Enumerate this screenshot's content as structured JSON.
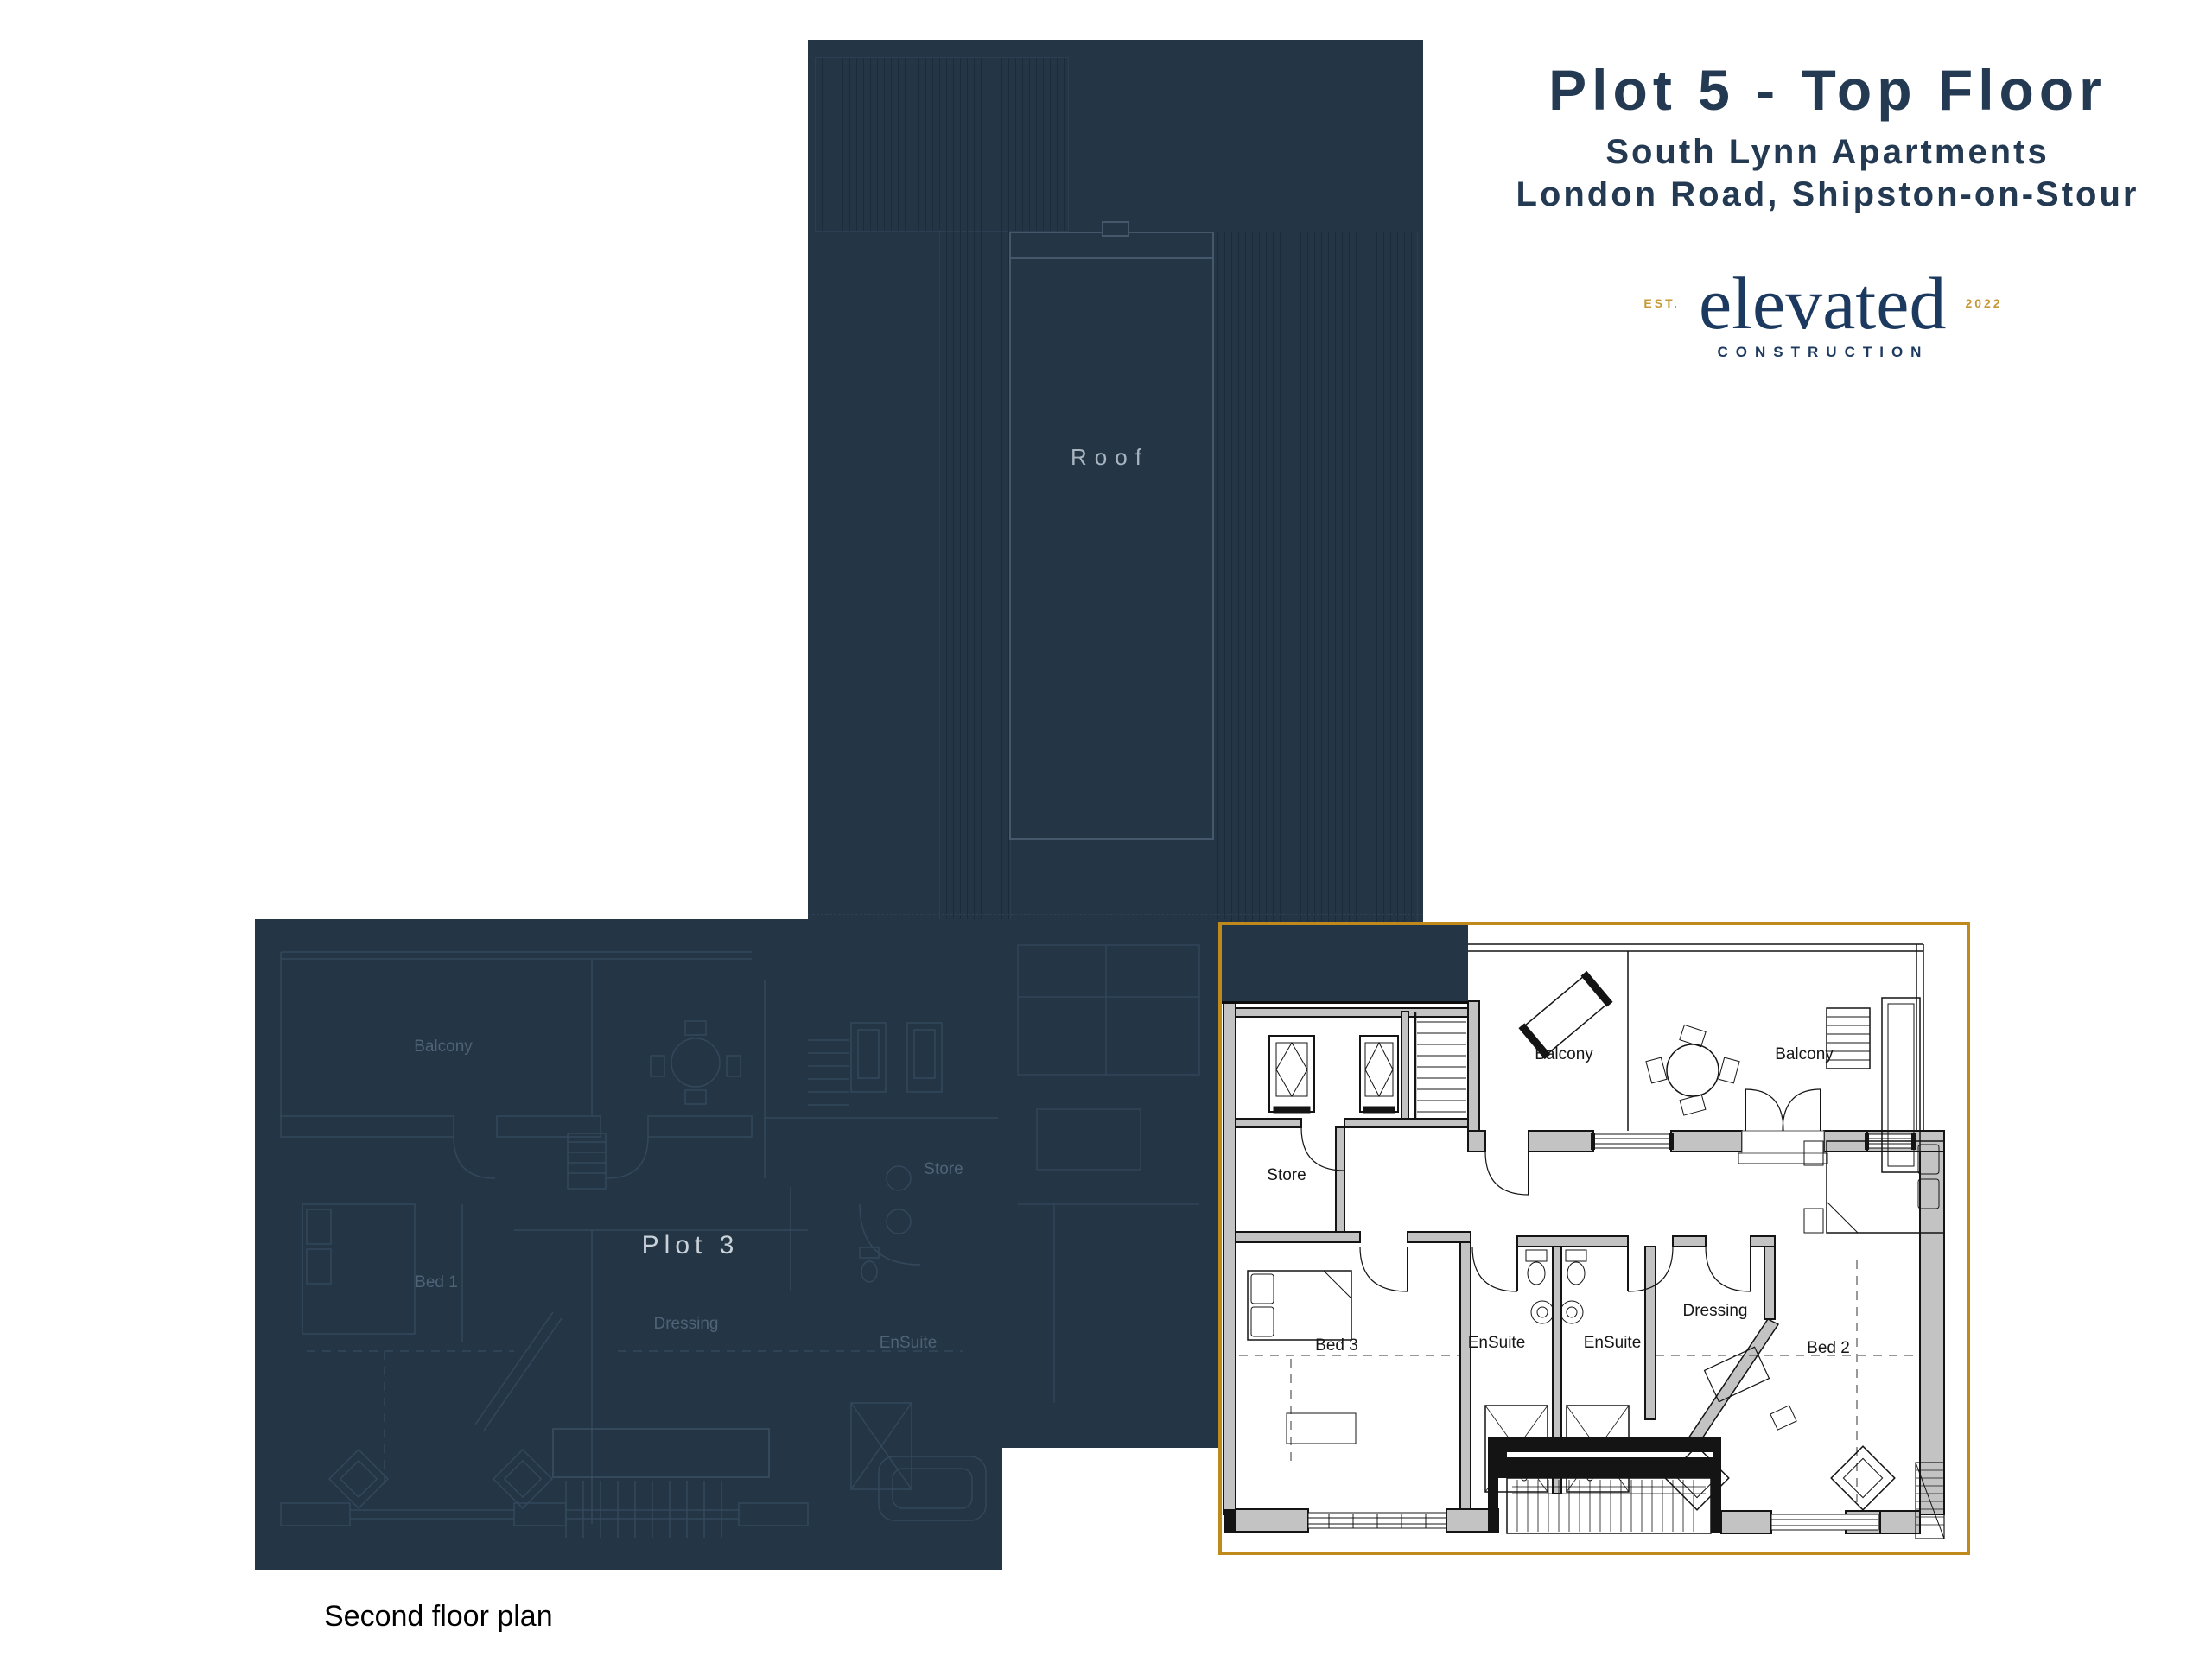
{
  "header": {
    "title": "Plot 5 - Top Floor",
    "subtitle1": "South Lynn Apartments",
    "subtitle2": "London Road, Shipston-on-Stour"
  },
  "logo": {
    "est": "EST.",
    "year": "2022",
    "name": "elevated",
    "tagline": "CONSTRUCTION"
  },
  "roof": {
    "label": "Roof"
  },
  "plot3": {
    "label": "Plot 3",
    "rooms": {
      "balcony": "Balcony",
      "store": "Store",
      "bed1": "Bed 1",
      "dressing": "Dressing",
      "ensuite": "EnSuite"
    }
  },
  "plan": {
    "rooms": {
      "balcony_left": "Balcony",
      "balcony_right": "Balcony",
      "store": "Store",
      "bed3": "Bed 3",
      "ensuite_left": "EnSuite",
      "ensuite_right": "EnSuite",
      "dressing": "Dressing",
      "bed2": "Bed 2"
    }
  },
  "caption": "Second floor plan",
  "colors": {
    "navy": "#243545",
    "navy_stripe": "#1d2c3b",
    "gold_border": "#bf8a1b",
    "logo_navy": "#1c3a5f",
    "logo_gold": "#c59a36",
    "title_navy": "#243a53",
    "wall_gray": "#c3c3c3",
    "line_black": "#141414"
  }
}
